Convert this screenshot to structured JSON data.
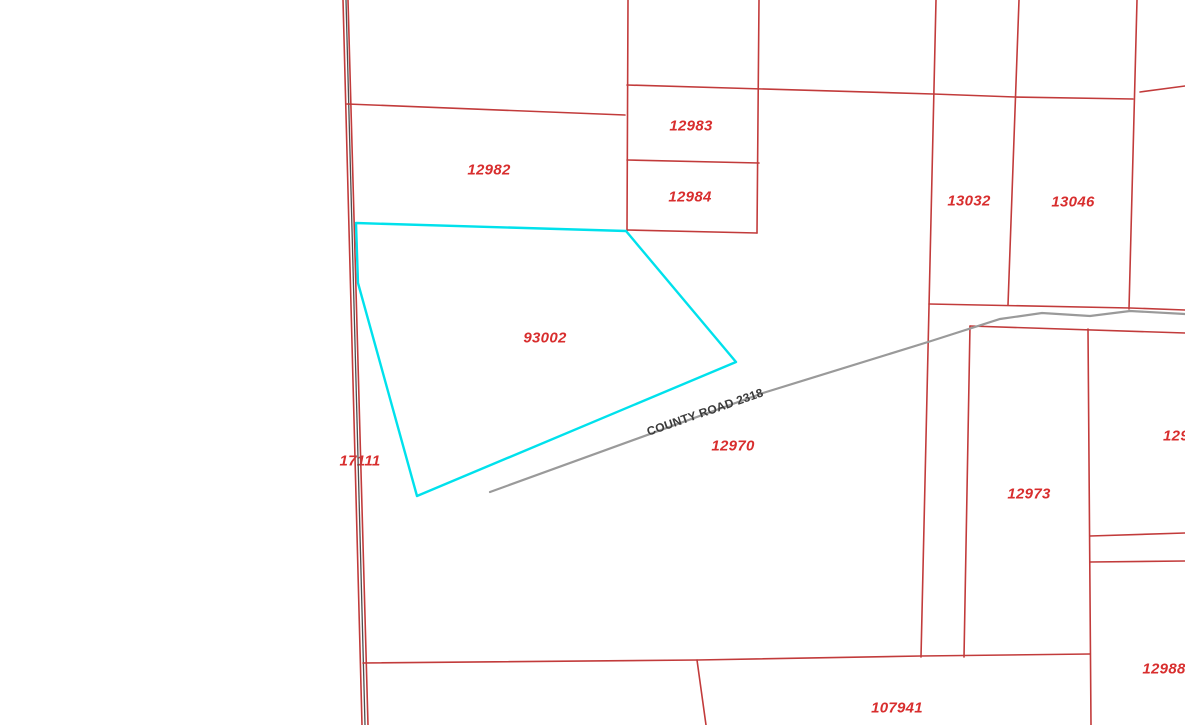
{
  "map": {
    "selected_parcel": {
      "id": "93002"
    },
    "parcel_labels": [
      {
        "id": "12982",
        "x": 489,
        "y": 170
      },
      {
        "id": "12983",
        "x": 691,
        "y": 126
      },
      {
        "id": "12984",
        "x": 690,
        "y": 197
      },
      {
        "id": "13032",
        "x": 969,
        "y": 201
      },
      {
        "id": "13046",
        "x": 1073,
        "y": 202
      },
      {
        "id": "93002",
        "x": 545,
        "y": 338
      },
      {
        "id": "17111",
        "x": 360,
        "y": 461
      },
      {
        "id": "12970",
        "x": 733,
        "y": 446
      },
      {
        "id": "12973",
        "x": 1029,
        "y": 494
      },
      {
        "id": "129",
        "x": 1176,
        "y": 436
      },
      {
        "id": "12988",
        "x": 1164,
        "y": 669
      },
      {
        "id": "107941",
        "x": 897,
        "y": 708
      }
    ],
    "road": {
      "label": "COUNTY ROAD 2318",
      "x": 705,
      "y": 412,
      "angle_deg": -19
    },
    "colors": {
      "background": "#ffffff",
      "parcel_line": "#c23b3b",
      "parcel_label": "#d82e2e",
      "selection": "#00e1ec",
      "road_line": "#9a9a9a",
      "road_centerline": "#4d4d4d",
      "road_label": "#3a3a3a"
    }
  }
}
